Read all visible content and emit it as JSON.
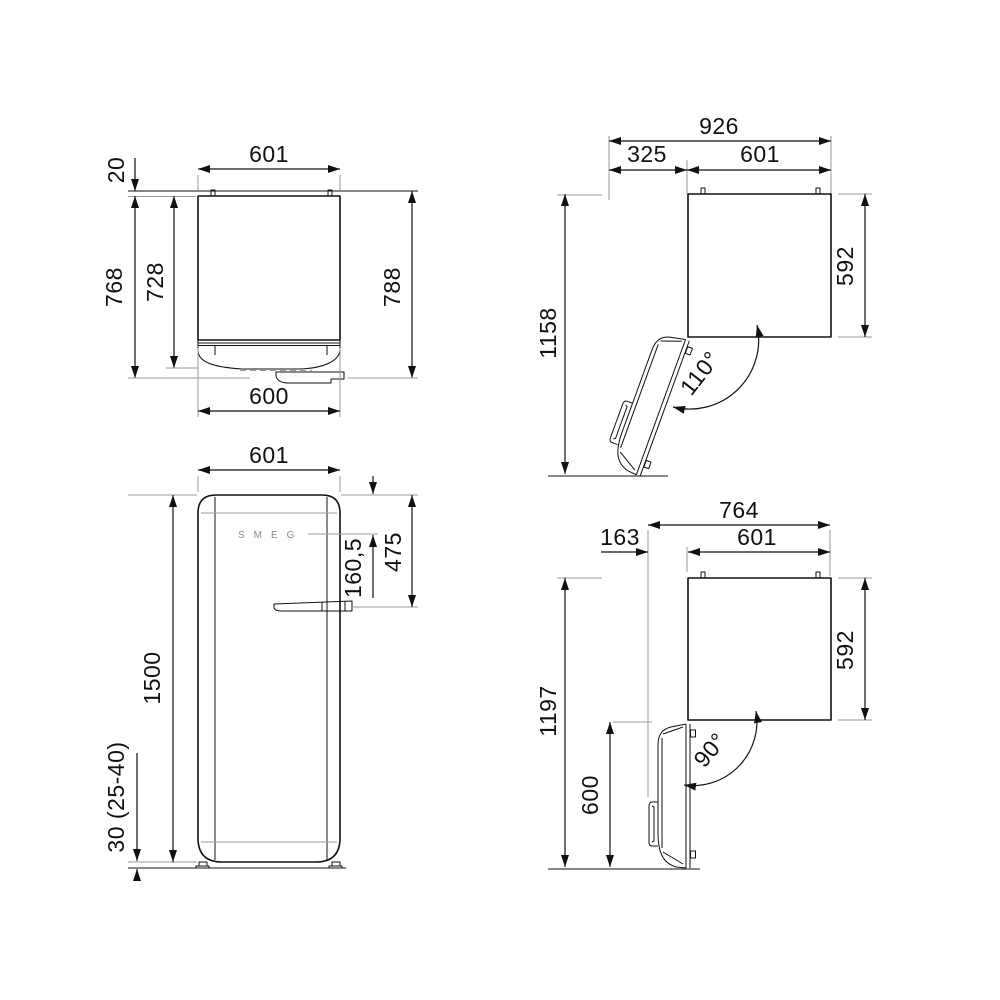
{
  "views": {
    "topClosed": {
      "width_top": "601",
      "wall_gap": "20",
      "depth_no_handle": "768",
      "body_depth": "728",
      "total_depth": "788",
      "door_width": "600"
    },
    "open110": {
      "overall_width": "926",
      "door_swing": "325",
      "body_width": "601",
      "body_depth": "592",
      "overall_depth": "1158",
      "angle": "110°"
    },
    "front": {
      "width": "601",
      "height": "1500",
      "handle_from_top": "475",
      "logo_from_top": "160,5",
      "feet_height": "30 (25-40)",
      "logo": "SMEG"
    },
    "open90": {
      "overall_width": "764",
      "door_swing": "163",
      "body_width": "601",
      "body_depth": "592",
      "overall_depth": "1197",
      "door_length": "600",
      "angle": "90°"
    }
  },
  "colors": {
    "line": "#111111",
    "extension": "#9a9a9a",
    "background": "#ffffff"
  }
}
